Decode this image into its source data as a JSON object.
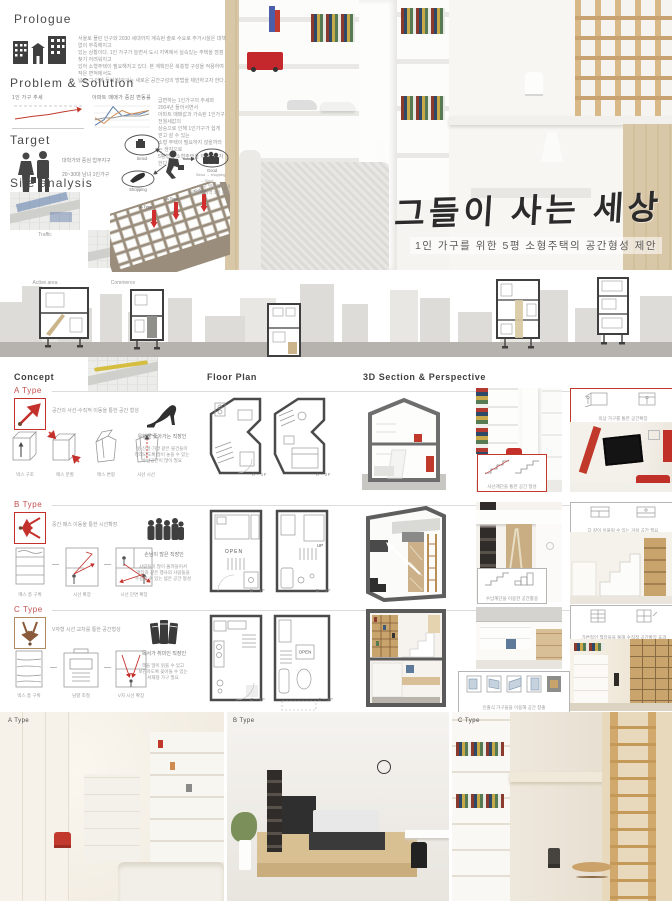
{
  "colors": {
    "accent_red": "#c0392b",
    "type_label": "#c0504d",
    "wood": "#d9bf98",
    "dark_gray": "#3a3a3a",
    "skyline_gray": "#dcdcda",
    "ground_gray": "#b6b3ae"
  },
  "hero": {
    "title": "그들이 사는 세상",
    "subtitle": "1인 가구를 위한 5평 소형주택의 공간형성 제안"
  },
  "prologue": {
    "title": "Prologue",
    "body_lines": [
      "서울로 몰린 인구와 2030 세대까지 계속된 솔로 수요로 주거시설은 대책없이 부족해지고",
      "있는 상황이다. 1인 가구가 늘면서 도시 지역에서 실속있는 주택을 점점 찾기 어려워지고",
      "있어 소형주택이 필요해지고 있다. 본 계획안은 복층형 구성을 적용하여 작은 면적에서도",
      "넓고 그 안에 들어 살아가는 새로운 공간구성의 방법을 제안하고자 한다."
    ]
  },
  "problem": {
    "title": "Problem & Solution",
    "note_lines": [
      "급변하는 1인가구의 추세와 2004년 들어서면서",
      "아파트 매매값과 가속된 1인가구 전월세값의",
      "상승으로 인해 1인가구가 쉽게 얻고 살 수 있는",
      "소형 주택이 필요하지 않을까라는 생각으로",
      "5평형의 소형주택을 제안하고자 한다."
    ]
  },
  "target": {
    "title": "Target",
    "desc_lines": [
      "대학가와 중심 업무지구",
      "20~30대 남녀 1인가구"
    ],
    "nodes": [
      "Seoul",
      "Good",
      "Shopping"
    ],
    "legend_lines": [
      "Seoul → shopping",
      "→ Good",
      "→ Seoul"
    ]
  },
  "site": {
    "title": "Site analysis",
    "map_labels": [
      "Traffic",
      "Culture",
      "Active area",
      "Commerce"
    ],
    "axon_caption_lines": [
      "인구 밀집지역 내",
      "가로활성지역 3곳 선정"
    ],
    "axon_arrow_labels": [
      "A Type",
      "B Type",
      "C Type"
    ]
  },
  "concept": {
    "header": "Concept",
    "floorplan_header": "Floor Plan",
    "section_header": "3D Section & Perspective",
    "rows": [
      {
        "type_label": "A Type",
        "concept_text": "공간의 사선·수직적 이동을 통한 공간 형성",
        "diagram_labels": [
          "박스 구조",
          "매스 분할",
          "매스 변형",
          "사선 시선"
        ],
        "persona_title": "유행을 좇아가는 직장인",
        "persona_desc_lines": [
          "옷·신발·가방 같은 물건들이",
          "정리되도록 많이 놓을 수 있는",
          "수납공간이 많이 필요"
        ],
        "plan_labels": [
          "A - 1F",
          "A - 2F"
        ],
        "callout_top": "의상 가구를 통한 공간확장",
        "callout_stair": "사선계단을 통한 공간 형성"
      },
      {
        "type_label": "B Type",
        "concept_text": "중간 매스 이동을 통한 시선확장",
        "diagram_labels": [
          "매스 층 구획",
          "시선 확장",
          "시선 단면 확장"
        ],
        "persona_title": "손님이 많은 직장인",
        "persona_desc_lines": [
          "사람들이 많이 몰려들어서",
          "파티와 같은 행사의 사람들을",
          "수용할 수 있는 넓은 공간 형성"
        ],
        "plan_labels": [
          "B - 1F",
          "B - 2F"
        ],
        "plan_texts": {
          "left": "OPEN",
          "right": "UP"
        },
        "callout_top": "다 같이 어울릴 수 있는 거실 공간 필요",
        "callout_stair": "수납계단을 이용한 공간활용"
      },
      {
        "type_label": "C Type",
        "concept_text": "V자형 시선 교차를 통한 공간형성",
        "diagram_labels": [
          "박스 층 구획",
          "남향 조절",
          "V자 시선 확장"
        ],
        "persona_title": "독서가 취미인 직장인",
        "persona_desc_lines": [
          "책을 많이 읽을 수 있고",
          "보관하도록 꽂아둘 수 있는",
          "서재형 가구 필요"
        ],
        "plan_labels": [
          "C - 1F",
          "C - 2F"
        ],
        "plan_texts": {
          "right": "OPEN"
        },
        "callout_top": "가변적인 책장들을 통해 수직적 공간확장 효과",
        "callout_stair": "인출식 가구들을 이용해 공간 창출"
      }
    ]
  },
  "bottom_renders": {
    "labels": [
      "A Type",
      "B Type",
      "C Type"
    ]
  },
  "chart_data": [
    {
      "type": "line",
      "title": "1인 가구 추세",
      "x": [
        1990,
        1995,
        2000,
        2005,
        2010
      ],
      "series": [
        {
          "name": "1인 가구 비율(%)",
          "values": [
            9,
            12.7,
            15.5,
            20,
            23.9
          ],
          "color": "#c0392b",
          "arrow": true
        }
      ],
      "ylim": [
        0,
        30
      ],
      "grid": false,
      "legend_position": "none"
    },
    {
      "type": "line",
      "title": "아파트 매매가 증감 변동률",
      "x": [
        2006,
        2007,
        2008,
        2009,
        2010,
        2011,
        2012
      ],
      "series": [
        {
          "name": "매매가",
          "values": [
            -2,
            1,
            8,
            3,
            4,
            4,
            6
          ],
          "color": "#5b7fae"
        },
        {
          "name": "전세가",
          "values": [
            2,
            -1,
            3,
            6,
            4,
            5,
            6
          ],
          "color": "#cf8a4e"
        },
        {
          "name": "물가",
          "values": [
            1,
            2,
            2,
            3,
            3,
            3,
            4
          ],
          "color": "#9a9a9a"
        }
      ],
      "ylim": [
        -4,
        10
      ],
      "grid": true,
      "legend_position": "none"
    }
  ]
}
